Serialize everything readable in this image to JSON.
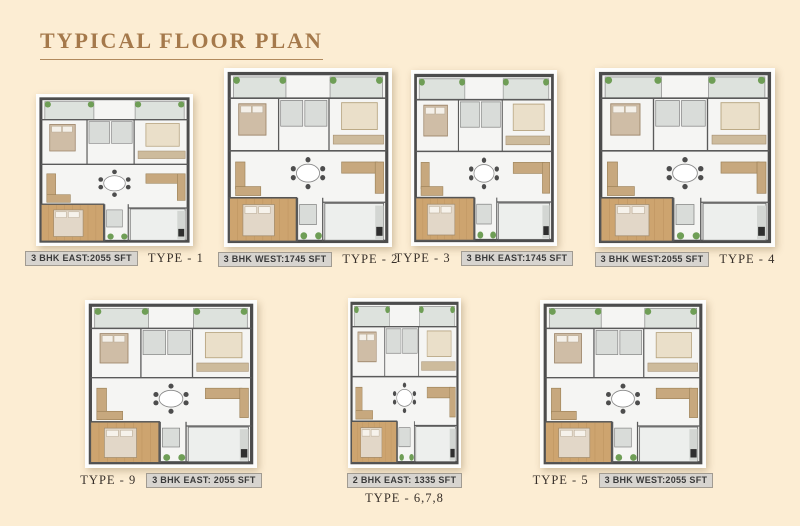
{
  "page": {
    "background_color": "#fcedd3",
    "accent_color": "#a5794b"
  },
  "header": {
    "title": "TYPICAL FLOOR PLAN"
  },
  "plans": [
    {
      "id": "type-1",
      "area_label": "3 BHK EAST:2055 SFT",
      "type_label": "TYPE - 1",
      "label_order": "area-first",
      "row": "top"
    },
    {
      "id": "type-2",
      "area_label": "3 BHK WEST:1745 SFT",
      "type_label": "TYPE - 2",
      "label_order": "area-first",
      "row": "top"
    },
    {
      "id": "type-3",
      "area_label": "3 BHK EAST:1745 SFT",
      "type_label": "TYPE - 3",
      "label_order": "type-first",
      "row": "top"
    },
    {
      "id": "type-4",
      "area_label": "3 BHK WEST:2055 SFT",
      "type_label": "TYPE - 4",
      "label_order": "area-first",
      "row": "top"
    },
    {
      "id": "type-9",
      "area_label": "3 BHK EAST: 2055 SFT",
      "type_label": "TYPE - 9",
      "label_order": "type-first",
      "row": "bottom"
    },
    {
      "id": "type-678",
      "area_label": "2 BHK EAST: 1335 SFT",
      "type_label": "TYPE - 6,7,8",
      "label_order": "stacked",
      "row": "bottom"
    },
    {
      "id": "type-5",
      "area_label": "3 BHK WEST:2055 SFT",
      "type_label": "TYPE - 5",
      "label_order": "type-first",
      "row": "bottom"
    }
  ],
  "plan_art_colors": {
    "wall": "#4c4c4c",
    "floor": "#f5f5f3",
    "wood_floor": "#cda46f",
    "balcony": "#dde2dd",
    "tile": "#d9dcd9",
    "furniture_wood": "#c7a87e",
    "plant_green": "#6f9e56"
  }
}
